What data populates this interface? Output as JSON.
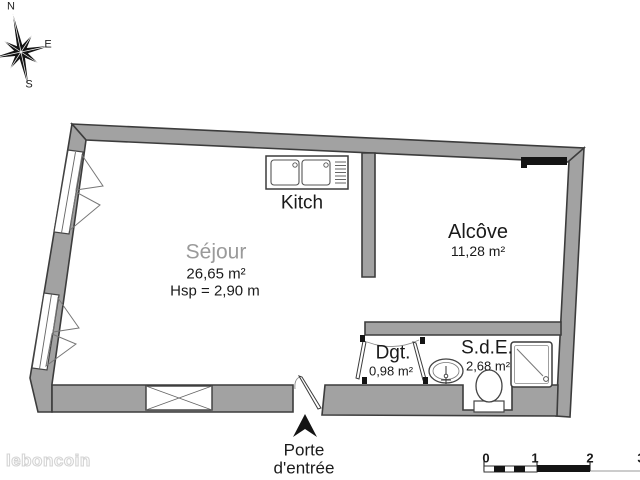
{
  "plan": {
    "rooms": {
      "sejour": {
        "name": "Séjour",
        "area": "26,65 m²",
        "ceiling": "Hsp = 2,90 m"
      },
      "kitchen": {
        "name": "Kitch"
      },
      "alcove": {
        "name": "Alcôve",
        "area": "11,28 m²"
      },
      "degagement": {
        "name": "Dgt.",
        "area": "0,98 m²"
      },
      "salle_eau": {
        "name": "S.d.E.",
        "area": "2,68 m²"
      }
    },
    "entrance": {
      "line1": "Porte",
      "line2": "d'entrée"
    }
  },
  "compass": {
    "north": "N",
    "east": "E",
    "south": "S"
  },
  "scale_bar": {
    "ticks": [
      "0",
      "1",
      "2",
      "3"
    ]
  },
  "watermark": {
    "text": "leboncoin"
  },
  "colors": {
    "wall_fill": "#a2a2a2",
    "wall_stroke": "#3c3c3c",
    "fixture_stroke": "#444444",
    "black_elements": "#141414",
    "sejour_label": "#9a9a9a",
    "text": "#1a1a1a"
  }
}
